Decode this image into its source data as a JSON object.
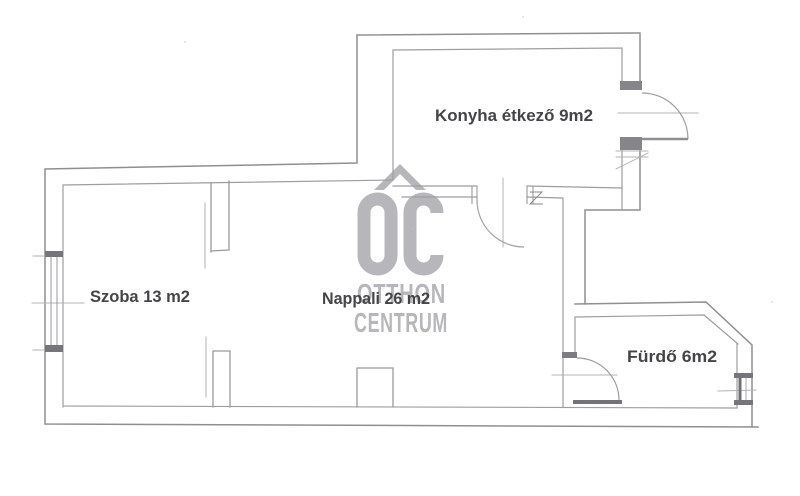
{
  "rooms": [
    {
      "id": "szoba",
      "label": "Szoba 13 m2"
    },
    {
      "id": "nappali",
      "label": "Nappali 26 m2"
    },
    {
      "id": "konyha",
      "label": "Konyha étkező 9m2"
    },
    {
      "id": "furdo",
      "label": "Fürdő 6m2"
    }
  ],
  "watermark": {
    "monogram": "OC",
    "brand_line1": "OTTHON",
    "brand_line2": "CENTRUM"
  },
  "colors": {
    "background": "#ffffff",
    "wall_outer": "#8f8f93",
    "wall_inner": "#9e9ea1",
    "wall_dark_fill": "#7d7d81",
    "faint_line": "#b3b3b6",
    "watermark_gray": "#b7b7bb",
    "label_text": "#454547"
  }
}
